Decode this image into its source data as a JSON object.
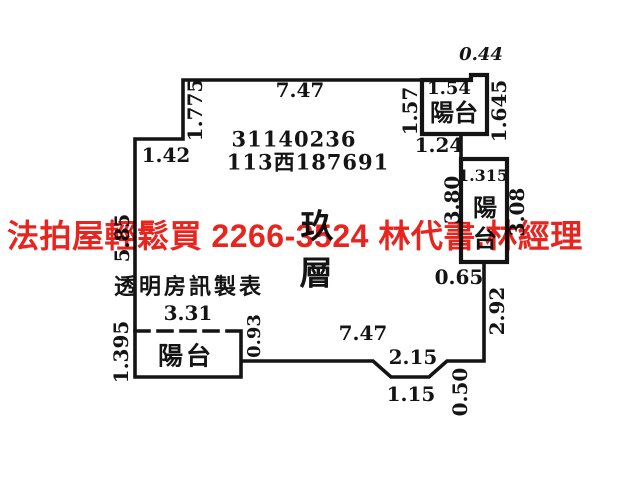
{
  "document": {
    "type_note": "building floor plan survey sketch",
    "floor_label": {
      "char_top": "玖",
      "char_bottom": "層"
    },
    "stamp": {
      "line1": "31140236",
      "line2": "113西187691"
    },
    "maker_note": "透明房訊製表"
  },
  "watermark": {
    "text": "法拍屋輕鬆買  2266-3524  林代書.林經理",
    "color": "#e8241f"
  },
  "balconies": {
    "top_label": "陽台",
    "bottom_label": "陽台",
    "right_label_char1": "陽",
    "right_label_char2": "台"
  },
  "dims": {
    "top_width": "7.47",
    "top_left_height": "1.775",
    "left_step": "1.42",
    "left_height": "5.85",
    "left_lower_height": "1.395",
    "bottom_balcony_width": "3.31",
    "bottom_balcony_right": "0.93",
    "bottom_width": "7.47",
    "notch_upper": "2.15",
    "notch_lower": "1.15",
    "notch_depth": "0.50",
    "right_lower_height": "2.92",
    "right_jog": "0.65",
    "right_balcony_inner": "3.80",
    "right_balcony_outer": "3.08",
    "right_balcony_width": "1.315",
    "top_balcony_below": "1.24",
    "top_balcony_left": "1.57",
    "top_balcony_width": "1.54",
    "top_balcony_right": "1.645",
    "top_balcony_notch": "0.44"
  },
  "colors": {
    "ink": "#141414",
    "watermark_red": "#e8241f",
    "background": "#ffffff"
  }
}
